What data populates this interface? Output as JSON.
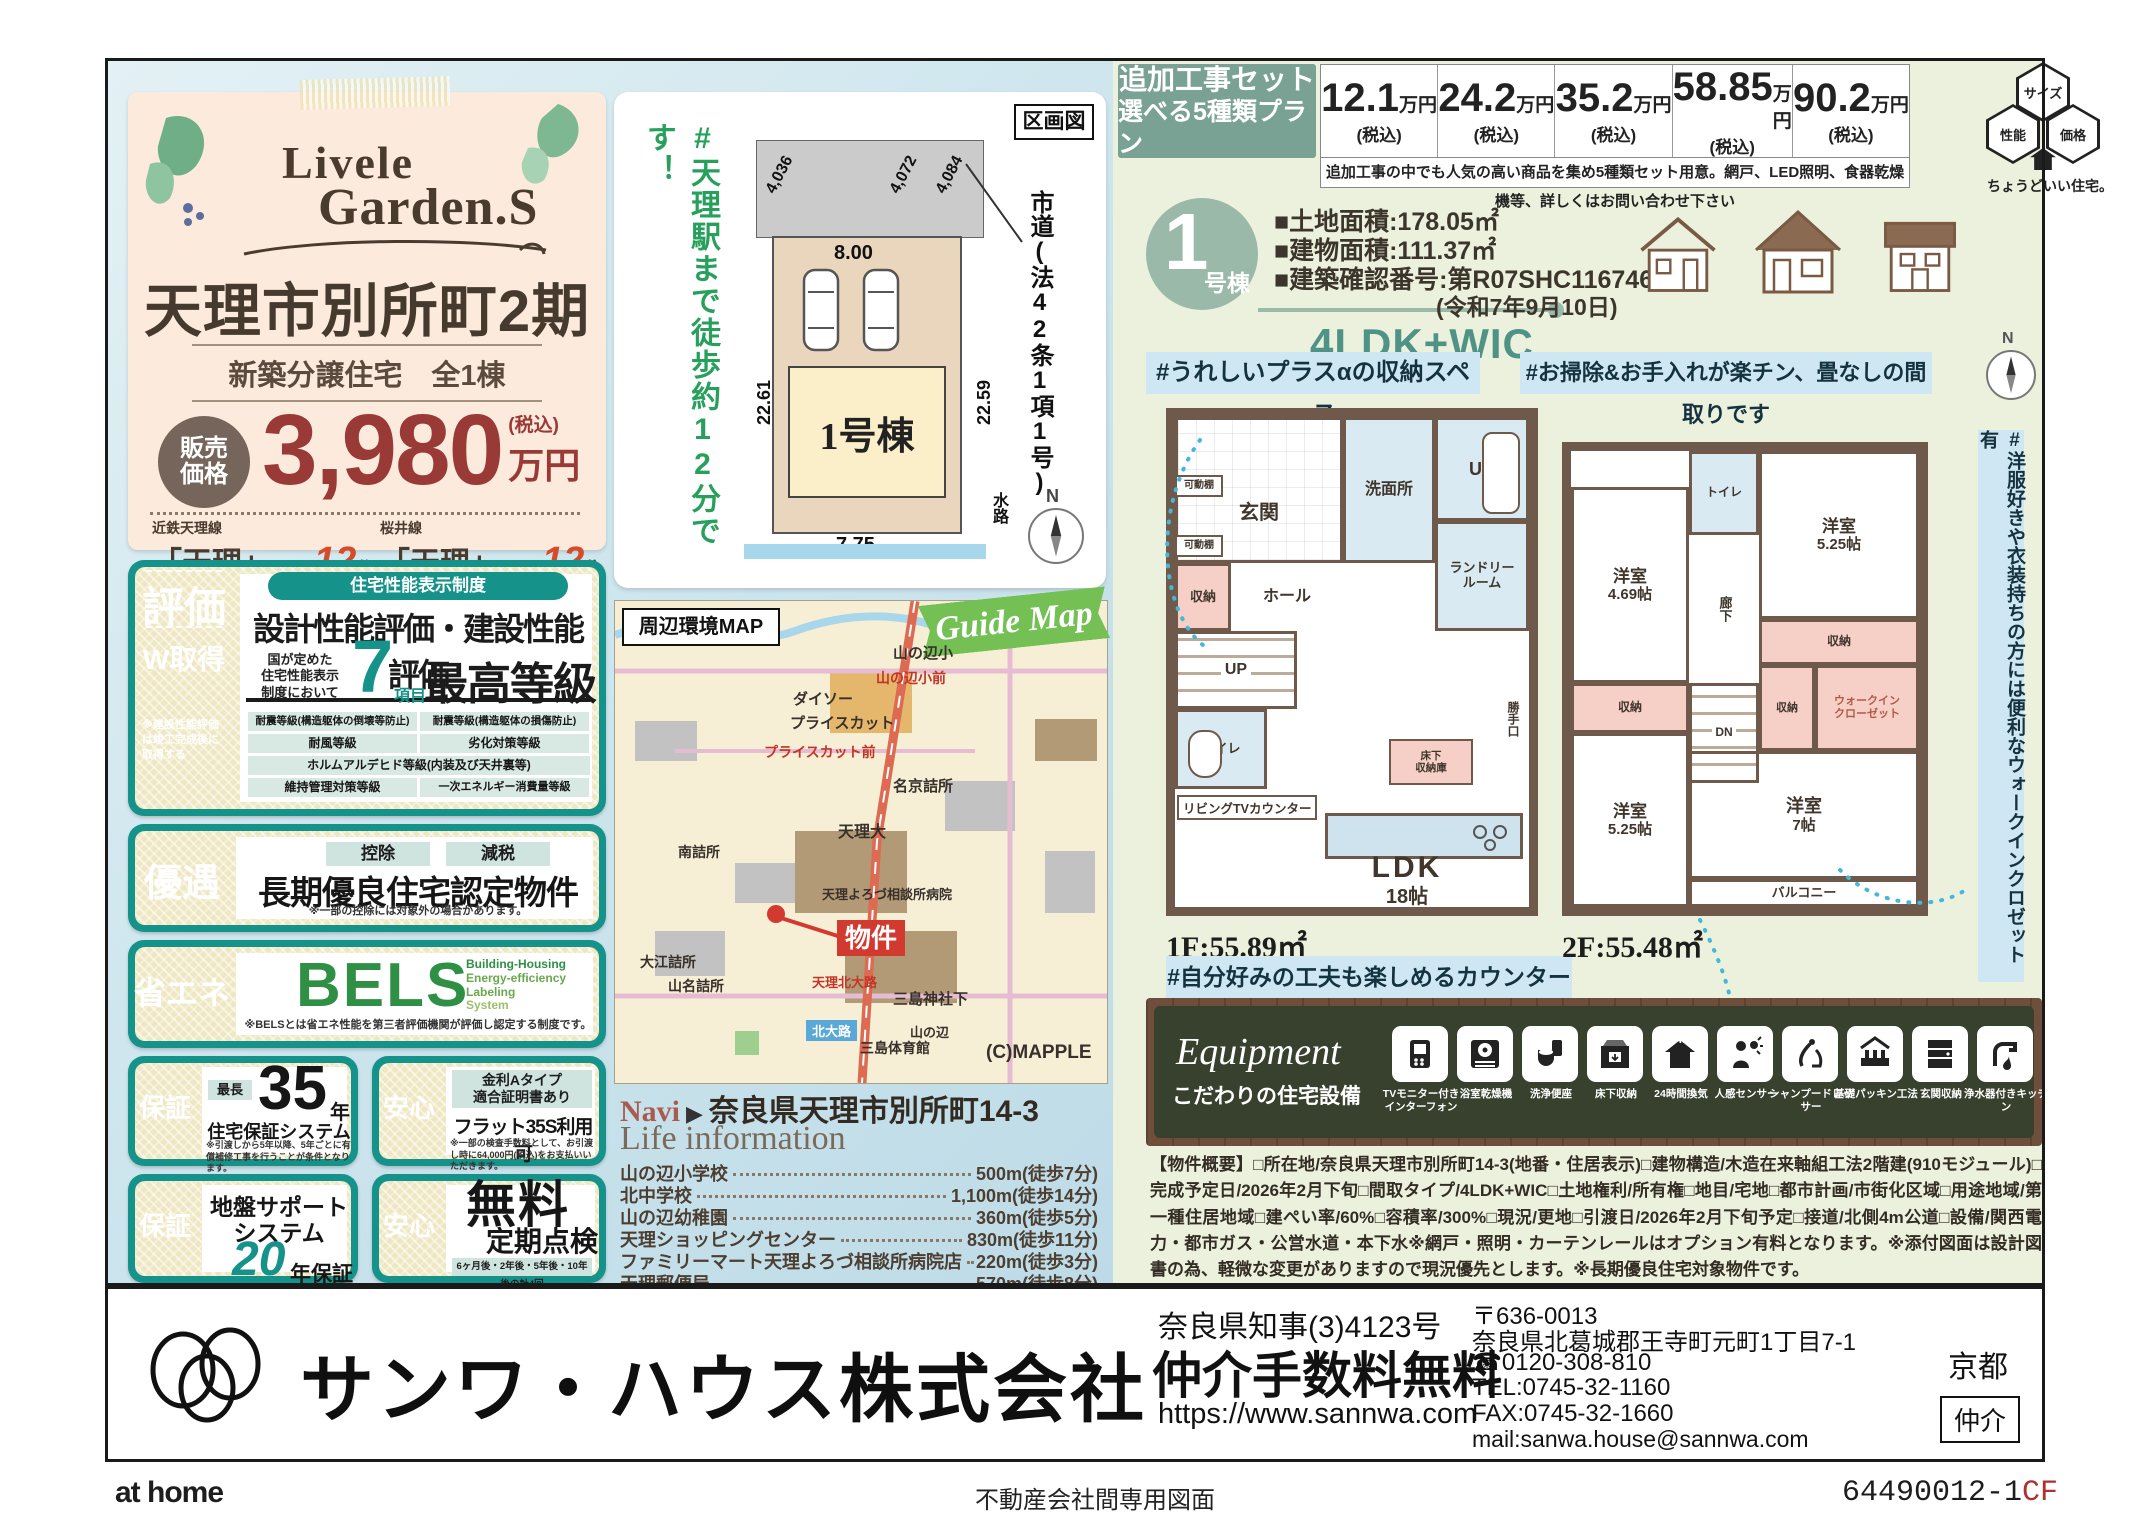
{
  "brand": {
    "logo1": "Livele",
    "logo2": "Garden.S"
  },
  "head": {
    "title": "天理市別所町2期",
    "subtitle": "新築分譲住宅　全1棟",
    "price_label1": "販売",
    "price_label2": "価格",
    "price": "3,980",
    "price_tax": "(税込)",
    "price_unit": "万円",
    "st1_line": "近鉄天理線",
    "st1_name": "「天理」",
    "st1_walk": "駅徒歩",
    "st1_min": "12",
    "st1_unit": "分",
    "st2_line": "桜井線",
    "st2_name": "「天理」",
    "st2_walk": "駅徒歩",
    "st2_min": "12",
    "st2_unit": "分"
  },
  "hyoka": {
    "badge": "評価",
    "badge2": "W取得",
    "badge_note": "※建設性能評価は竣工完成後に取得する",
    "pill": "住宅性能表示制度",
    "title": "設計性能評価・建設性能評価",
    "lead1": "国が定めた",
    "lead2": "住宅性能表示",
    "lead3": "制度において",
    "num": "7",
    "num_unit": "項目",
    "grade": "最高等級",
    "cells": [
      "耐震等級(構造躯体の倒壊等防止)",
      "耐震等級(構造躯体の損傷防止)",
      "耐風等級",
      "劣化対策等級",
      "ホルムアルデヒド等級(内装及び天井裏等)",
      "維持管理対策等級",
      "一次エネルギー消費量等級"
    ]
  },
  "yugu": {
    "badge": "優遇",
    "pill1": "控除",
    "pill2": "減税",
    "title": "長期優良住宅認定物件",
    "note": "※一部の控除には対象外の場合があります。"
  },
  "shoene": {
    "badge": "省エネ",
    "logo": "BELS",
    "sub1": "Building-Housing",
    "sub2": "Energy-efficiency",
    "sub3": "Labeling",
    "sub4": "System",
    "note": "※BELSとは省エネ性能を第三者評価機関が評価し認定する制度です。"
  },
  "hosho35": {
    "badge": "保証",
    "pill": "最長",
    "num": "35",
    "unit": "年",
    "title": "住宅保証システム",
    "note": "※引渡しから5年以降、5年ごとに有償補修工事を行うことが条件となります。"
  },
  "flat35": {
    "badge": "安心",
    "pill1": "金利Aタイプ",
    "pill2": "適合証明書あり",
    "title": "フラット35S利用可",
    "note": "※一部の検査手数料として、お引渡し時に64,000円(税込)をお支払いいただきます。"
  },
  "jiban": {
    "badge": "保証",
    "title1": "地盤サポート",
    "title2": "システム",
    "num": "20",
    "unit": "年保証"
  },
  "teiki": {
    "badge": "安心",
    "title1": "無料",
    "title2": "定期点検",
    "note": "6ヶ月後・2年後・5年後・10年後の計4回"
  },
  "lot": {
    "hashtag": "#天理駅まで徒歩約12分です！",
    "corner": "区画図",
    "d1": "4,036",
    "d2": "4,072",
    "d3": "4,084",
    "w_top": "8.00",
    "w_left": "22.61",
    "w_right": "22.59",
    "w_bottom": "7.75",
    "bldg": "1号棟",
    "road": "市道(法42条1項1号)",
    "water": "水路",
    "north": "N"
  },
  "map": {
    "title": "周辺環境MAP",
    "ribbon": "Guide Map",
    "bukken": "物件",
    "mapple": "(C)MAPPLE",
    "navi_label": "Navi",
    "navi_arrow": "▶",
    "navi_addr": "奈良県天理市別所町14-3",
    "labels": [
      "山の辺小",
      "ダイソー",
      "プライスカット",
      "プライスカット前",
      "山の辺小前",
      "名京詰所",
      "天理大",
      "天理よろづ相談所病院",
      "三島神社下",
      "三島体育館",
      "北大路",
      "山の辺",
      "大江詰所",
      "山名詰所",
      "南詰所",
      "天理北大路"
    ]
  },
  "life": {
    "header": "Life information",
    "items": [
      {
        "name": "山の辺小学校",
        "dist": "500m(徒歩7分)"
      },
      {
        "name": "北中学校",
        "dist": "1,100m(徒歩14分)"
      },
      {
        "name": "山の辺幼稚園",
        "dist": "360m(徒歩5分)"
      },
      {
        "name": "天理ショッピングセンター",
        "dist": "830m(徒歩11分)"
      },
      {
        "name": "ファミリーマート天理よろづ相談所病院店",
        "dist": "220m(徒歩3分)"
      },
      {
        "name": "天理郵便局",
        "dist": "570m(徒歩8分)"
      }
    ]
  },
  "addon": {
    "t1": "追加工事セット",
    "t2": "選べる5種類プラン",
    "prices": [
      {
        "v": "12.1",
        "u": "万円",
        "t": "(税込)"
      },
      {
        "v": "24.2",
        "u": "万円",
        "t": "(税込)"
      },
      {
        "v": "35.2",
        "u": "万円",
        "t": "(税込)"
      },
      {
        "v": "58.85",
        "u": "万円",
        "t": "(税込)"
      },
      {
        "v": "90.2",
        "u": "万円",
        "t": "(税込)"
      }
    ],
    "note": "追加工事の中でも人気の高い商品を集め5種類セット用意。網戸、LED照明、食器乾燥機等、詳しくはお問い合わせ下さい",
    "hex1": "サイズ",
    "hex2": "性能",
    "hex3": "価格",
    "hex_sub": "ちょうどいい住宅。"
  },
  "unit": {
    "num": "1",
    "suffix": "号棟",
    "land": "■土地面積:178.05㎡",
    "bldg": "■建物面積:111.37㎡",
    "kakunin": "■建築確認番号:第R07SHC116746号",
    "kakunin2": "(令和7年9月10日)",
    "plan": "4LDK+WIC"
  },
  "tags": {
    "t1": "#うれしいプラスαの収納スペース",
    "t2": "#お掃除&お手入れが楽チン、畳なしの間取りです",
    "t3": "#自分好みの工夫も楽しめるカウンターキッチン",
    "t4": "#洋服好きや衣装持ちの方には便利なウォークインクロゼット有"
  },
  "f1": {
    "label": "1F:55.89㎡",
    "genkan": "玄関",
    "kadana1": "可動棚",
    "kadana2": "可動棚",
    "senmen": "洗面所",
    "ub": "UB",
    "laundry1": "ランドリー",
    "laundry2": "ルーム",
    "shuno": "収納",
    "hall": "ホール",
    "up": "UP",
    "toilet": "トイレ",
    "tv": "リビングTVカウンター",
    "yukashita1": "床下",
    "yukashita2": "収納庫",
    "katte": "勝手口",
    "ldk": "LDK",
    "ldk_size": "18帖"
  },
  "f2": {
    "label": "2F:55.48㎡",
    "toilet": "トイレ",
    "r1": "洋室",
    "r1s": "4.69帖",
    "r2": "洋室",
    "r2s": "5.25帖",
    "rouka": "廊下",
    "dn": "DN",
    "shuno1": "収納",
    "shuno2": "収納",
    "shuno3": "収納",
    "wic1": "ウォークイン",
    "wic2": "クローゼット",
    "r3": "洋室",
    "r3s": "5.25帖",
    "r4": "洋室",
    "r4s": "7帖",
    "balcony": "バルコニー"
  },
  "equip": {
    "title": "Equipment",
    "subtitle": "こだわりの住宅設備",
    "badge24h": "24H",
    "items": [
      "TVモニター付きインターフォン",
      "浴室乾燥機",
      "洗浄便座",
      "床下収納",
      "24時間換気",
      "人感センサー",
      "シャンプードレッサー",
      "基礎パッキン工法",
      "玄関収納",
      "浄水器付きキッチン"
    ]
  },
  "overview": {
    "text": "【物件概要】□所在地/奈良県天理市別所町14-3(地番・住居表示)□建物構造/木造在来軸組工法2階建(910モジュール)□完成予定日/2026年2月下旬□間取タイプ/4LDK+WIC□土地権利/所有権□地目/宅地□都市計画/市街化区域□用途地域/第一種住居地域□建ぺい率/60%□容積率/300%□現況/更地□引渡日/2026年2月下旬予定□接道/北側4m公道□設備/関西電力・都市ガス・公営水道・本下水※網戸・照明・カーテンレールはオプション有料となります。※添付図面は設計図書の為、軽微な変更がありますので現況優先とします。※長期優良住宅対象物件です。"
  },
  "company": {
    "name": "サンワ・ハウス株式会社",
    "license": "奈良県知事(3)4123号",
    "fee": "仲介手数料無料",
    "url": "https://www.sannwa.com",
    "zip": "〒636-0013",
    "addr": "奈良県北葛城郡王寺町元町1丁目7-1",
    "freedial": "☎0120-308-810",
    "tel": "TEL:0745-32-1160",
    "fax": "FAX:0745-32-1660",
    "mail": "mail:sanwa.house@sannwa.com",
    "branch": "京都",
    "type": "仲介"
  },
  "footer": {
    "athome": "at home",
    "center": "不動産会社間専用図面",
    "code": "64490012-1",
    "code2": "CF"
  }
}
